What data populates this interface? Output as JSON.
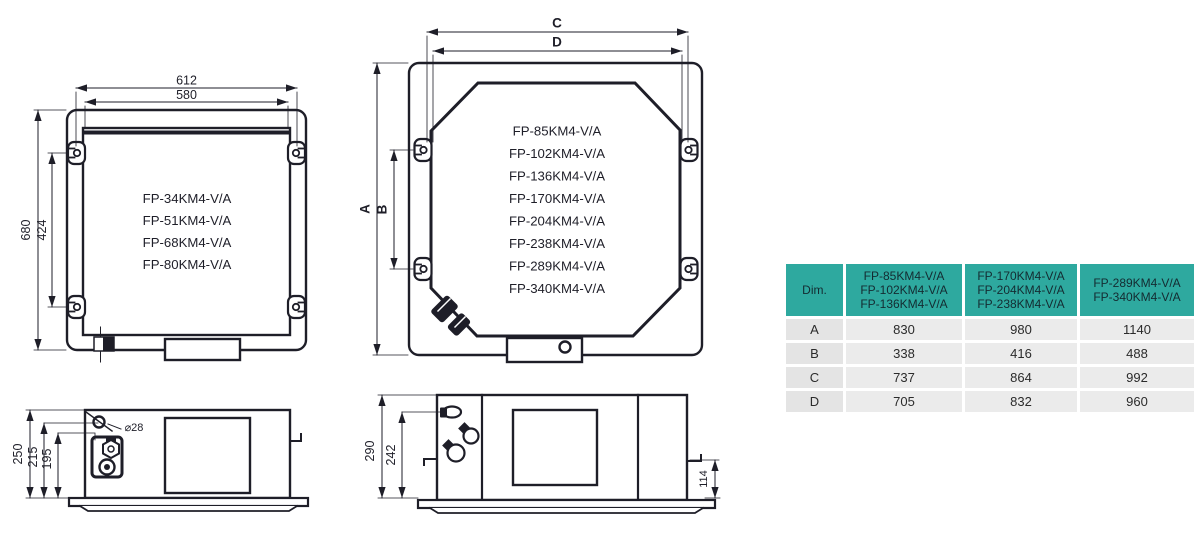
{
  "meta": {
    "description": "Dimensional drawings of FP-KM4-V/A ceiling cassette fan coil units with spec table",
    "colors": {
      "line": "#1e1e28",
      "accent_teal": "#2ea99f",
      "row_gray": "#ebebeb",
      "label_gray": "#e4e4e4",
      "background": "#ffffff"
    }
  },
  "drawings": {
    "small_plan": {
      "width_outer": "612",
      "width_inner": "580",
      "height_outer": "680",
      "height_inner": "424",
      "models": [
        "FP-34KM4-V/A",
        "FP-51KM4-V/A",
        "FP-68KM4-V/A",
        "FP-80KM4-V/A"
      ]
    },
    "large_plan": {
      "dim_c": "C",
      "dim_d": "D",
      "dim_a": "A",
      "dim_b": "B",
      "models": [
        "FP-85KM4-V/A",
        "FP-102KM4-V/A",
        "FP-136KM4-V/A",
        "FP-170KM4-V/A",
        "FP-204KM4-V/A",
        "FP-238KM4-V/A",
        "FP-289KM4-V/A",
        "FP-340KM4-V/A"
      ]
    },
    "small_side": {
      "height_total": "250",
      "height_mid": "215",
      "height_inner": "195",
      "hole_diameter": "⌀28"
    },
    "large_side": {
      "height_total": "290",
      "height_mid": "242",
      "height_flange": "114"
    }
  },
  "table": {
    "dim_header": "Dim.",
    "col_groups": [
      {
        "lines": [
          "FP-85KM4-V/A",
          "FP-102KM4-V/A",
          "FP-136KM4-V/A"
        ]
      },
      {
        "lines": [
          "FP-170KM4-V/A",
          "FP-204KM4-V/A",
          "FP-238KM4-V/A"
        ]
      },
      {
        "lines": [
          "FP-289KM4-V/A",
          "FP-340KM4-V/A"
        ]
      }
    ],
    "rows": [
      {
        "label": "A",
        "values": [
          "830",
          "980",
          "1140"
        ]
      },
      {
        "label": "B",
        "values": [
          "338",
          "416",
          "488"
        ]
      },
      {
        "label": "C",
        "values": [
          "737",
          "864",
          "992"
        ]
      },
      {
        "label": "D",
        "values": [
          "705",
          "832",
          "960"
        ]
      }
    ]
  }
}
